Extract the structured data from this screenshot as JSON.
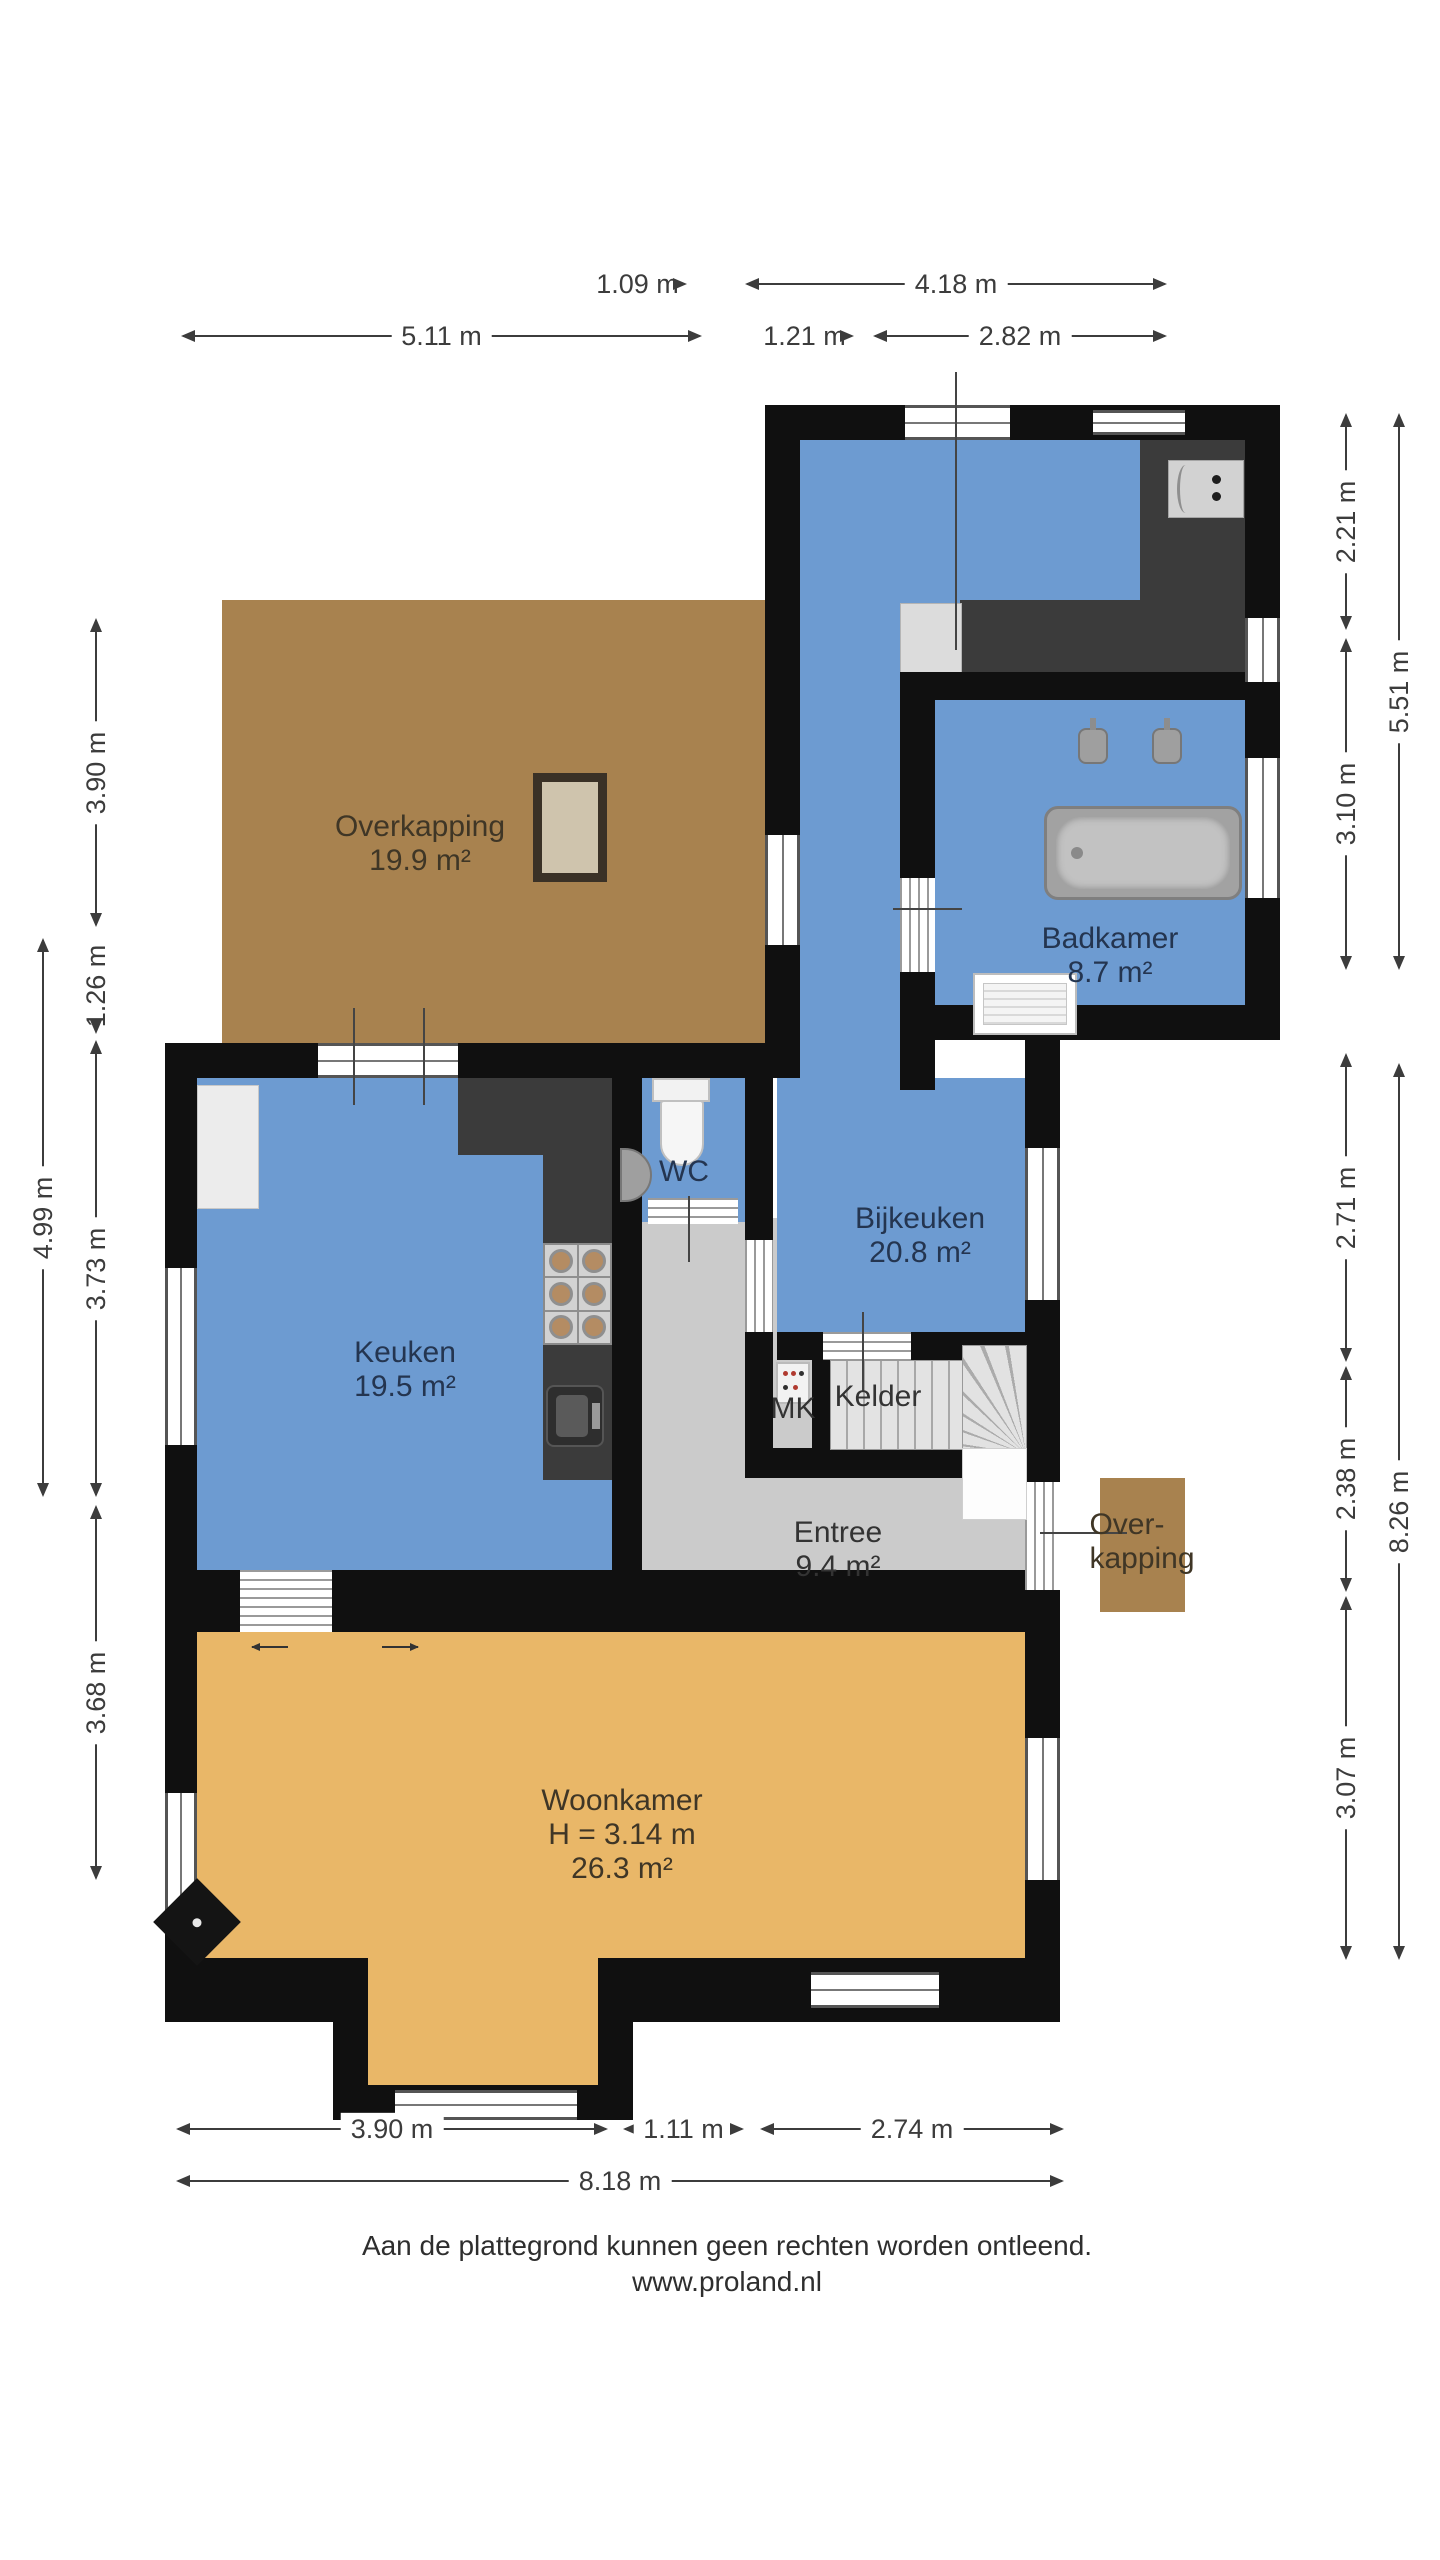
{
  "palette": {
    "floor_blue": "#6d9bd1",
    "floor_tan": "#e9b768",
    "floor_brown": "#a8824f",
    "floor_gray": "#cbcbcb",
    "wall_black": "#101010",
    "counter_dark": "#3b3b3b",
    "blue_room_label": "#243550",
    "dimension_text": "#3c3c3c"
  },
  "rooms": {
    "overkapping": {
      "name": "Overkapping",
      "area": "19.9 m²"
    },
    "badkamer": {
      "name": "Badkamer",
      "area": "8.7 m²"
    },
    "bijkeuken": {
      "name": "Bijkeuken",
      "area": "20.8 m²"
    },
    "wc": {
      "name": "WC"
    },
    "keuken": {
      "name": "Keuken",
      "area": "19.5 m²"
    },
    "mk": {
      "name": "MK"
    },
    "kelder": {
      "name": "Kelder"
    },
    "entree": {
      "name": "Entree",
      "area": "9.4 m²"
    },
    "overkapping_small": {
      "line1": "Over-",
      "line2": "kapping"
    },
    "woonkamer": {
      "name": "Woonkamer",
      "height": "H = 3.14 m",
      "area": "26.3 m²"
    }
  },
  "dimensions": {
    "top_small": "1.09 m",
    "top_wing_width": "4.18 m",
    "top_left_width": "5.11 m",
    "top_mid": "1.21 m",
    "top_right": "2.82 m",
    "left_overkapping": "3.90 m",
    "left_small": "1.26 m",
    "left_keuken": "3.73 m",
    "left_woonkamer": "3.68 m",
    "left_total": "4.99 m",
    "right_counter": "2.21 m",
    "right_badkamer": "3.10 m",
    "right_wing_total": "5.51 m",
    "right_bijkeuken": "2.71 m",
    "right_entree": "2.38 m",
    "right_woonkamer": "3.07 m",
    "right_house_total": "8.26 m",
    "bottom_left": "3.90 m",
    "bottom_mid": "1.11 m",
    "bottom_right": "2.74 m",
    "bottom_total": "8.18 m"
  },
  "footer": {
    "line1": "Aan de plattegrond kunnen geen rechten worden ontleend.",
    "line2": "www.proland.nl"
  }
}
